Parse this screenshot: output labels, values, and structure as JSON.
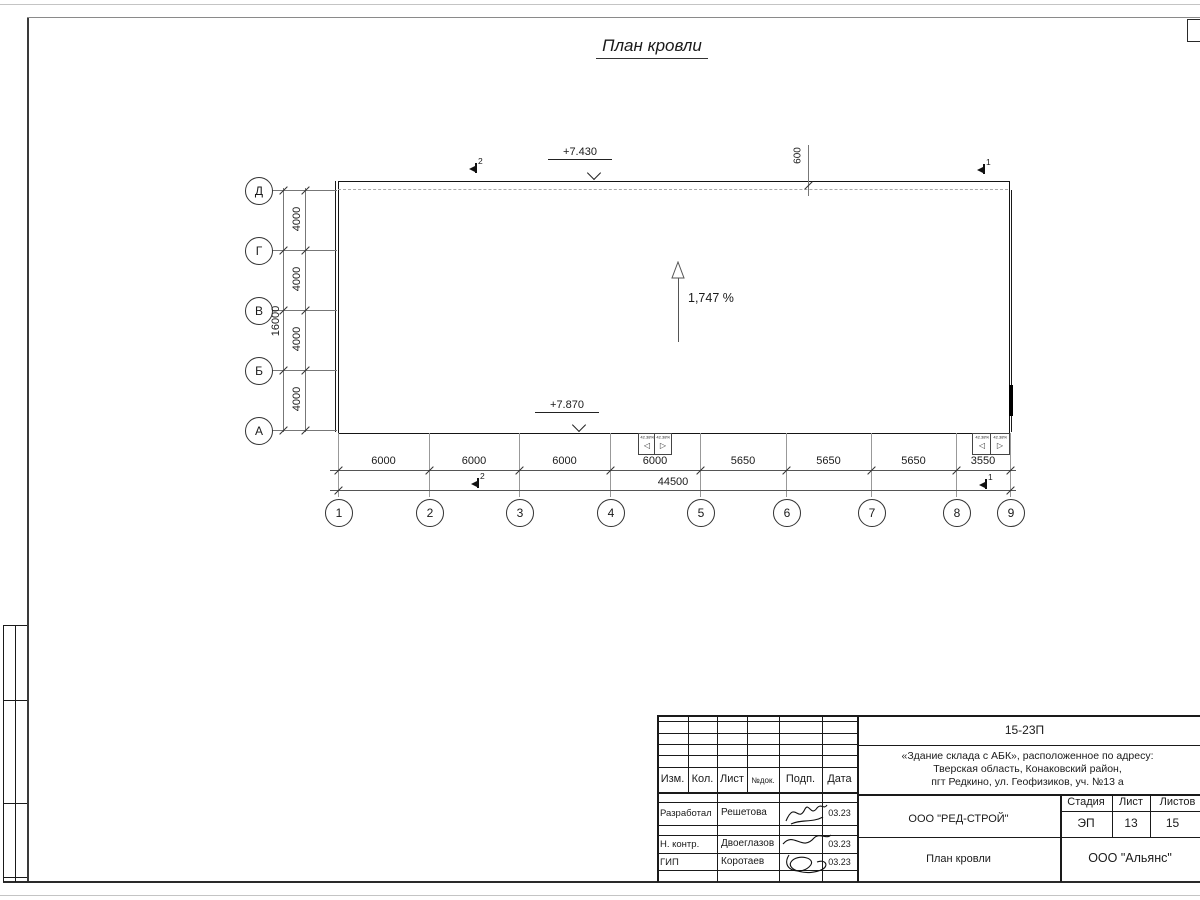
{
  "sheet": {
    "title": "План кровли"
  },
  "plan": {
    "row_axes": [
      "Д",
      "Г",
      "В",
      "Б",
      "А"
    ],
    "col_axes": [
      "1",
      "2",
      "3",
      "4",
      "5",
      "6",
      "7",
      "8",
      "9"
    ],
    "row_dims": [
      "4000",
      "4000",
      "4000",
      "4000"
    ],
    "row_total": "16000",
    "col_dims": [
      "6000",
      "6000",
      "6000",
      "6000",
      "5650",
      "5650",
      "5650",
      "3550"
    ],
    "col_total": "44500",
    "elevation_top": "+7.430",
    "elevation_bottom": "+7.870",
    "parapet_offset": "600",
    "slope_label": "1,747 %",
    "drain_slope": "42.38%",
    "section_mark_1": "1",
    "section_mark_2": "2"
  },
  "title_block": {
    "doc_number": "15-23П",
    "address_line1": "«Здание склада с АБК», расположенное по адресу:",
    "address_line2": "Тверская область, Конаковский район,",
    "address_line3": "пгт Редкино, ул. Геофизиков, уч. №13 а",
    "col_izm": "Изм.",
    "col_kol": "Кол.",
    "col_list": "Лист",
    "col_ndok": "№док.",
    "col_podp": "Подп.",
    "col_data": "Дата",
    "rows": [
      {
        "role": "Разработал",
        "name": "Решетова",
        "date": "03.23"
      },
      {
        "role": "Н. контр.",
        "name": "Двоеглазов",
        "date": "03.23"
      },
      {
        "role": "ГИП",
        "name": "Коротаев",
        "date": "03.23"
      }
    ],
    "company": "ООО \"РЕД-СТРОЙ\"",
    "stage_label": "Стадия",
    "sheet_label": "Лист",
    "sheets_label": "Листов",
    "stage_value": "ЭП",
    "sheet_value": "13",
    "sheets_value": "15",
    "drawing_title": "План кровли",
    "org": "ООО \"Альянс\""
  }
}
